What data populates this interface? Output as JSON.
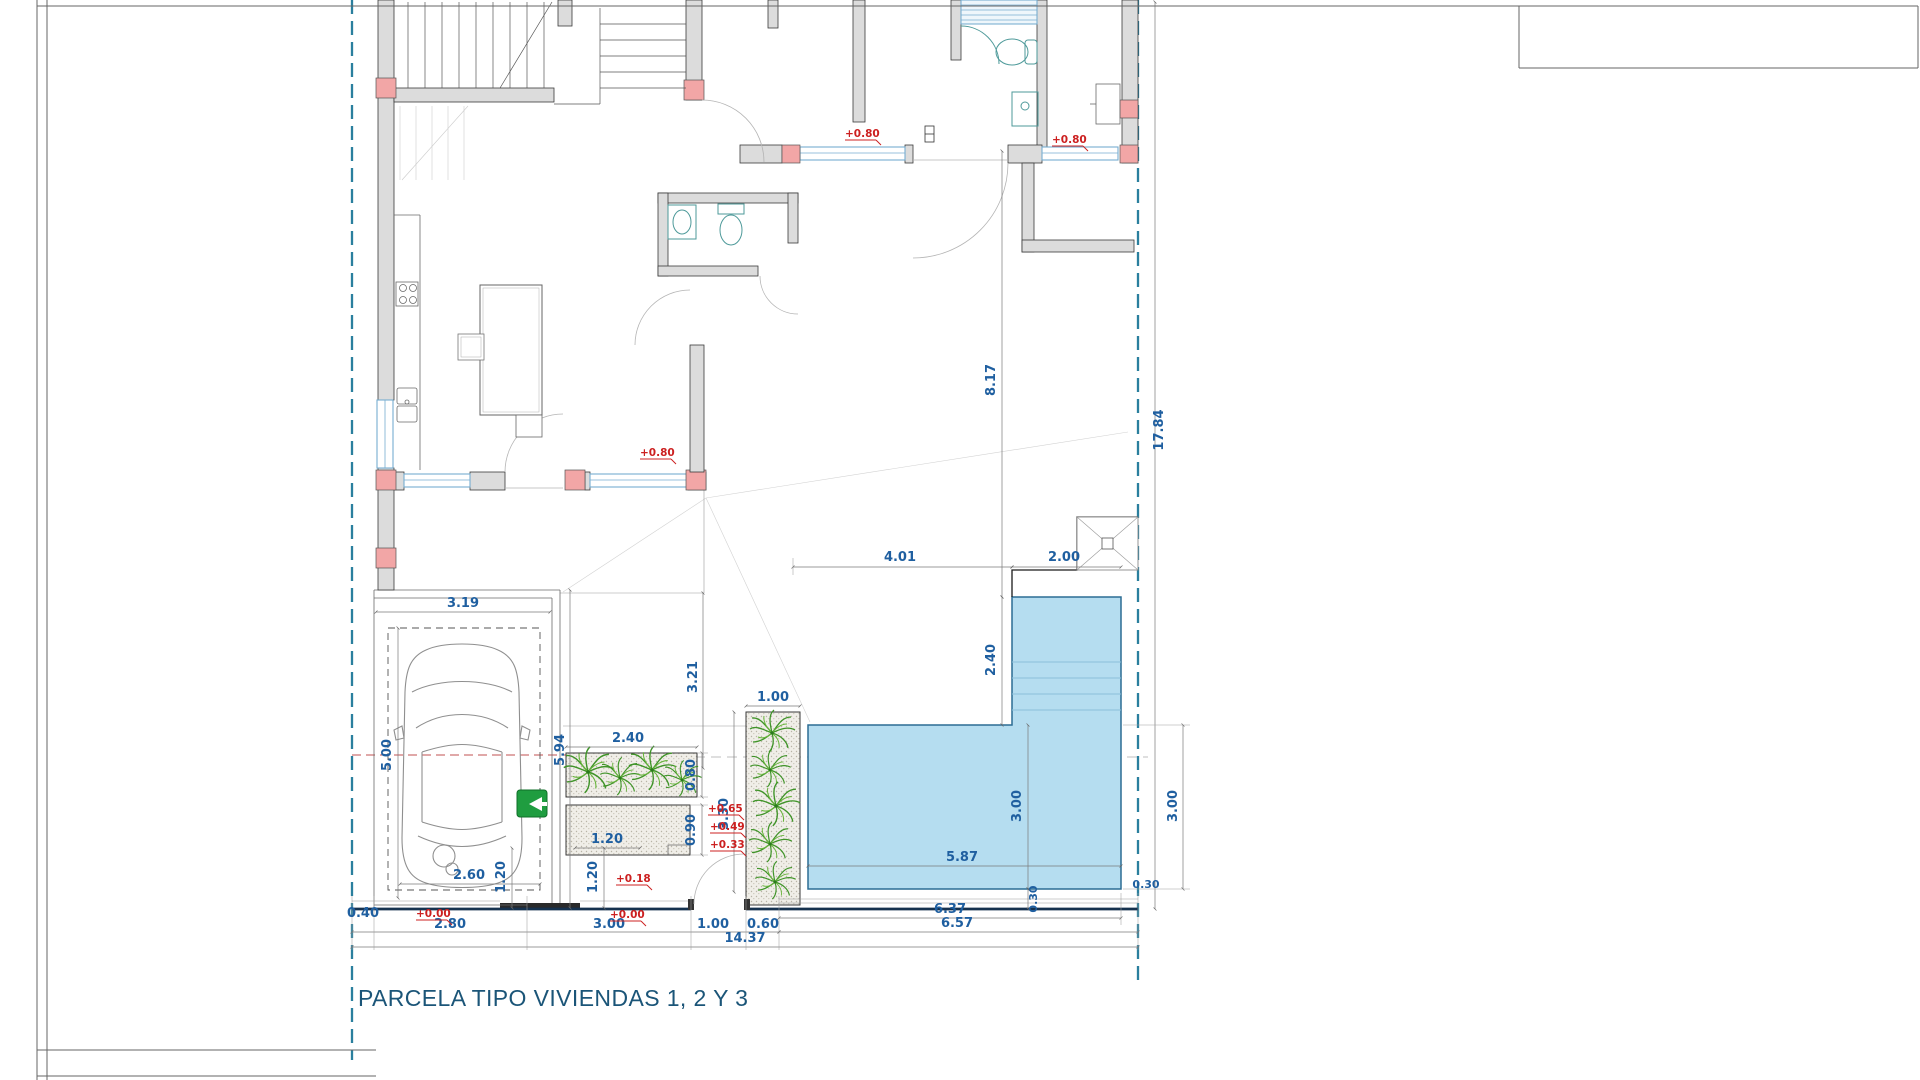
{
  "sheet": {
    "title": "PARCELA TIPO VIVIENDAS 1, 2 Y 3",
    "colors": {
      "dimension_text": "#1f5fa0",
      "level_text": "#cc2020",
      "boundary": "#2a7f9e",
      "pool_fill": "#b5ddf0",
      "pool_edge": "#2c6d94",
      "wall_fill": "#dcdcdc",
      "column_fill": "#f2a6a6",
      "plant": "#3f9428",
      "sign_green": "#1f9d40",
      "window": "#77aed0",
      "title": "#1b5578"
    }
  },
  "levels": {
    "living": "+0.80",
    "bath": "+0.80",
    "bedroom": "+0.80",
    "step3": "+0.65",
    "step2": "+0.49",
    "step1": "+0.33",
    "landing": "+0.18",
    "street_a": "+0.00",
    "street_b": "+0.00"
  },
  "dims": {
    "garage_width": "3.19",
    "parking_length": "5.00",
    "garage_depth": "5.94",
    "car_width": "2.60",
    "planter_front_width": "2.40",
    "planter_front_depth": "0.80",
    "steps_depth": "0.90",
    "walkway_a": "1.20",
    "walkway_b": "1.20",
    "walkway_c": "1.20",
    "planter_side_width": "1.00",
    "planter_side_length": "3.30",
    "path_length": "3.21",
    "patio_to_pool": "4.01",
    "pool_head_width": "2.00",
    "pool_head_length": "2.40",
    "patio_length": "8.17",
    "parcel_length": "17.84",
    "pool_width_inner": "3.00",
    "pool_width_outer": "3.00",
    "pool_offset_a": "0.30",
    "pool_offset_b": "0.30",
    "pool_length_dim": "5.87",
    "front_040": "0.40",
    "front_280": "2.80",
    "front_300": "3.00",
    "front_100": "1.00",
    "front_060": "0.60",
    "front_637": "6.37",
    "front_657": "6.57",
    "front_total": "14.37"
  }
}
